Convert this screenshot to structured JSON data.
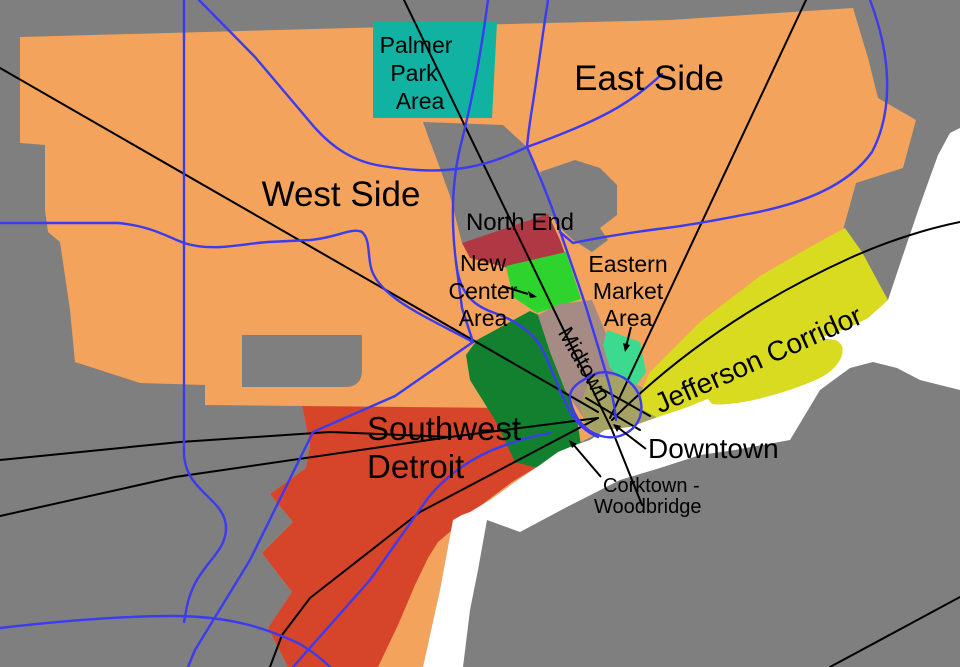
{
  "map": {
    "description": "Detroit neighborhoods map",
    "labels": {
      "palmer_park": [
        "Palmer",
        "Park",
        "Area"
      ],
      "east_side": "East Side",
      "west_side": "West Side",
      "north_end": "North End",
      "new_center": [
        "New",
        "Center",
        "Area"
      ],
      "midtown": "Midtown",
      "eastern_market": [
        "Eastern",
        "Market",
        "Area"
      ],
      "jefferson_corridor": "Jefferson Corridor",
      "southwest_detroit": [
        "Southwest",
        "Detroit"
      ],
      "downtown": "Downtown",
      "corktown_woodbridge": [
        "Corktown -",
        "Woodbridge"
      ]
    },
    "regions": [
      {
        "name": "West Side",
        "color": "#F3A35B"
      },
      {
        "name": "East Side",
        "color": "#F3A35B"
      },
      {
        "name": "Palmer Park Area",
        "color": "#12B2A2"
      },
      {
        "name": "North End",
        "color": "#B03845"
      },
      {
        "name": "New Center Area",
        "color": "#2ED32E"
      },
      {
        "name": "Eastern Market Area",
        "color": "#3BDA8E"
      },
      {
        "name": "Midtown",
        "color": "#A68B85"
      },
      {
        "name": "Downtown",
        "color": "#A6A263"
      },
      {
        "name": "Corktown - Woodbridge",
        "color": "#138030"
      },
      {
        "name": "Jefferson Corridor",
        "color": "#D9DB21"
      },
      {
        "name": "Southwest Detroit",
        "color": "#D6452A"
      }
    ],
    "colors": {
      "background": "#7F7F7F",
      "city": "#F3A35B",
      "enclave": "#7F7F7F",
      "palmer_park": "#12B2A2",
      "north_end": "#B03845",
      "new_center": "#2ED32E",
      "eastern_market": "#3BDA8E",
      "midtown": "#A68B85",
      "downtown": "#A6A263",
      "corktown": "#138030",
      "jefferson": "#D9DB21",
      "belle_isle": "#D9DB21",
      "southwest": "#D6452A",
      "water": "#FFFFFF",
      "freeway": "#3B3BF0",
      "road": "#000000",
      "text": "#000000"
    }
  }
}
